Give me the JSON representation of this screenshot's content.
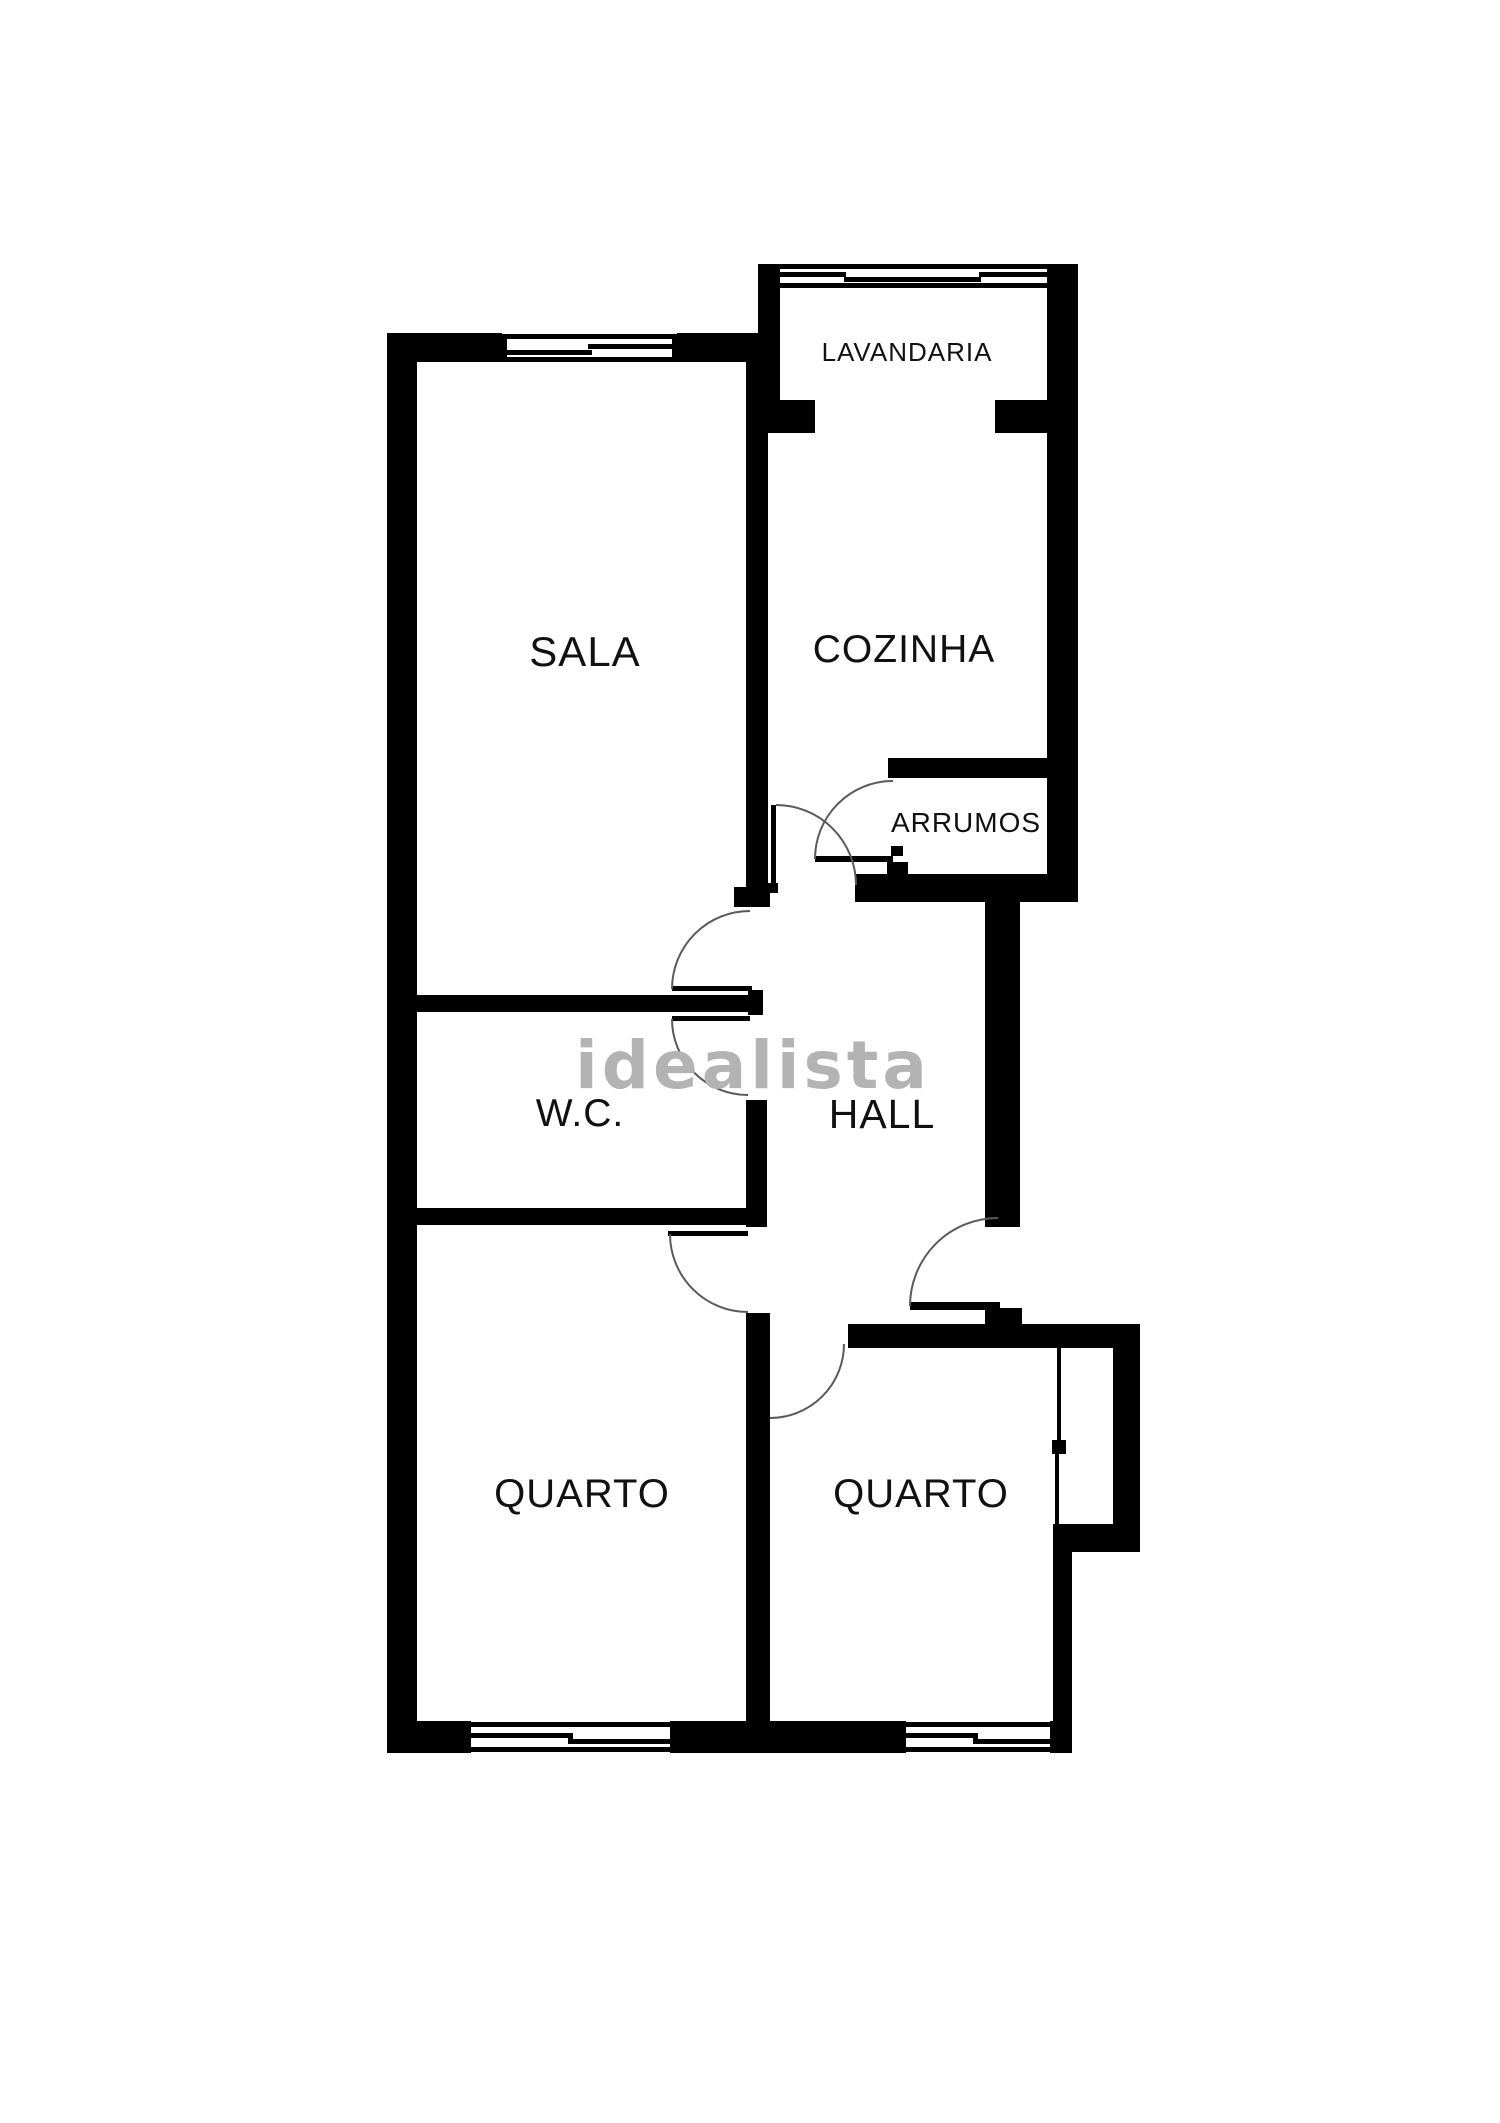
{
  "plan": {
    "watermark": "idealista",
    "rooms": {
      "lavandaria": {
        "label": "LAVANDARIA"
      },
      "cozinha": {
        "label": "COZINHA"
      },
      "sala": {
        "label": "SALA"
      },
      "arrumos": {
        "label": "ARRUMOS"
      },
      "wc": {
        "label": "W.C."
      },
      "hall": {
        "label": "HALL"
      },
      "quarto_left": {
        "label": "QUARTO"
      },
      "quarto_right": {
        "label": "QUARTO"
      }
    },
    "colors": {
      "wall": "#000000",
      "label": "#111111",
      "door_arc": "#5a5a5a",
      "watermark": "#b3b3b3",
      "background": "#ffffff"
    }
  }
}
